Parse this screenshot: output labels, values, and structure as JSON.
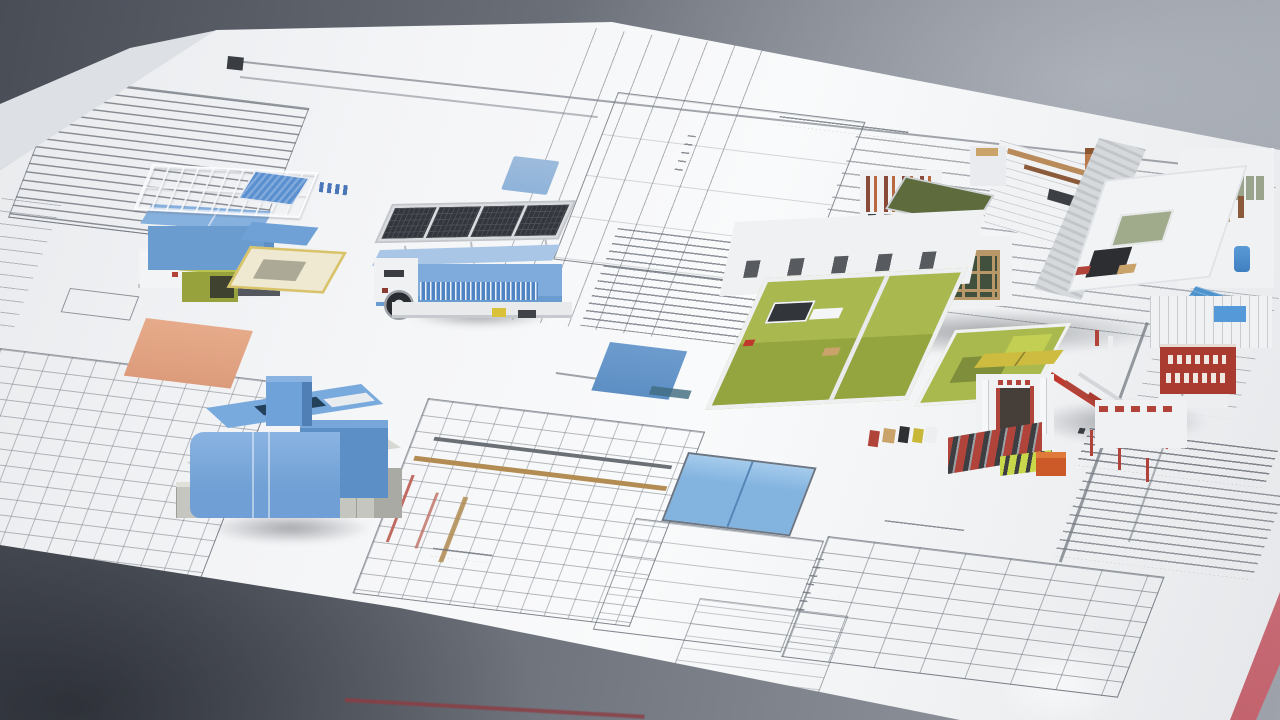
{
  "scene": {
    "type": "photograph-recreation",
    "description": "Architectural scale models standing on stacked technical blueprint sheets, photographed on a gray studio surface",
    "palette": {
      "bgDark": "#494d56",
      "bgMid": "#6e737c",
      "bgLight": "#9da2ab",
      "paper": "#f4f5f7",
      "paperShade": "#e7e9ec",
      "underSheet": "#dde0e4",
      "ink": "#7c828a",
      "inkDark": "#3a3d42",
      "blue": "#79aade",
      "blueDark": "#5d8fc7",
      "blueLight": "#a9c6e6",
      "bluePale": "#86b0de",
      "panelDark": "#33363c",
      "olive": "#97a23c",
      "oliveLight": "#b8c24e",
      "yellowTrim": "#d8c36a",
      "paleYellow": "#cdbc3f",
      "yellowGreen": "#c8d84a",
      "concrete": "#c6c6c1",
      "concreteDark": "#aaaaa5",
      "white": "#f0f1f3",
      "greenFloor": "#a9b84f",
      "greenDark": "#94a43f",
      "greenRoof": "#5d6b3d",
      "woodTan": "#b89868",
      "copper": "#b87a4a",
      "brick": "#8a4a3a",
      "brickLight": "#b8693f",
      "red": "#b0443a",
      "redBright": "#c0392f",
      "signRed": "#a93b30",
      "orangeZone": "#dc9c7c",
      "orangeBox": "#cc5a28",
      "highlightBlue": "#83b4e0",
      "poolBlue": "#4f93cc",
      "skyBlueBar": "#8fb3d9",
      "pinkEdge": "#c9737c",
      "redLine": "#8e3c42"
    },
    "sheets": [
      {
        "id": "main-sheet",
        "label": "Large blueprint sheet covering the table"
      },
      {
        "id": "under-sheet",
        "label": "Second sheet corner at upper left"
      },
      {
        "id": "red-sheet-edge",
        "label": "Red sheet edge at lower right corner"
      }
    ],
    "models": [
      {
        "id": "model-a",
        "label": "Blue module with rooftop railing frame, striped blue stair canopy, yellow-trimmed courtyard and olive service bin",
        "color": "#6b9ccf"
      },
      {
        "id": "model-b",
        "label": "Trailer module with photovoltaic canopy, blue shell, louvered band and single wheel",
        "color": "#7fabdc"
      },
      {
        "id": "model-c",
        "label": "Blue courtyard block with tower fin on a concrete plinth",
        "color": "#79aade"
      },
      {
        "id": "model-d",
        "label": "White building complex with green room interiors, timber windows, rooftop terrace, red stair and red signage",
        "color": "#f0f1f3"
      }
    ],
    "drawings": [
      {
        "id": "spec-block-top-left",
        "label": "Specification text block with border frame"
      },
      {
        "id": "plan-grid-bottom-left",
        "label": "Dense floor plan linework"
      },
      {
        "id": "column-grid-top-center",
        "label": "Column grid with dimension lines"
      },
      {
        "id": "plan-outline-top-center",
        "label": "Room plan outline with margin notes"
      },
      {
        "id": "parallel-bands-right",
        "label": "Parallel section bands"
      },
      {
        "id": "spec-block-center",
        "label": "Specification notes block"
      },
      {
        "id": "plan-gold-beams",
        "label": "Framing plan with timber beams highlighted in gold"
      },
      {
        "id": "schedule-table-bottom",
        "label": "Schedule table grid"
      },
      {
        "id": "spec-blocks-right",
        "label": "Notes column at right edge"
      },
      {
        "id": "handwriting",
        "label": "Pencil annotation squiggle"
      }
    ],
    "highlights": [
      {
        "id": "orange-zone",
        "color": "#dc9c7c",
        "label": "Orange shaded plan zone"
      },
      {
        "id": "blue-bar",
        "color": "#8fb3d9",
        "label": "Small blue highlighted bar"
      },
      {
        "id": "blue-zone-mid",
        "color": "#5d8fc4",
        "label": "Blue shaded roof plan element"
      },
      {
        "id": "blue-room",
        "color": "#83b4e0",
        "label": "Blue shaded room pair in plan"
      },
      {
        "id": "pool",
        "color": "#4f93cc",
        "label": "Blue pool on terrace"
      },
      {
        "id": "red-sign",
        "color": "#a93b30",
        "label": "Red sign band with white lettering"
      }
    ]
  }
}
